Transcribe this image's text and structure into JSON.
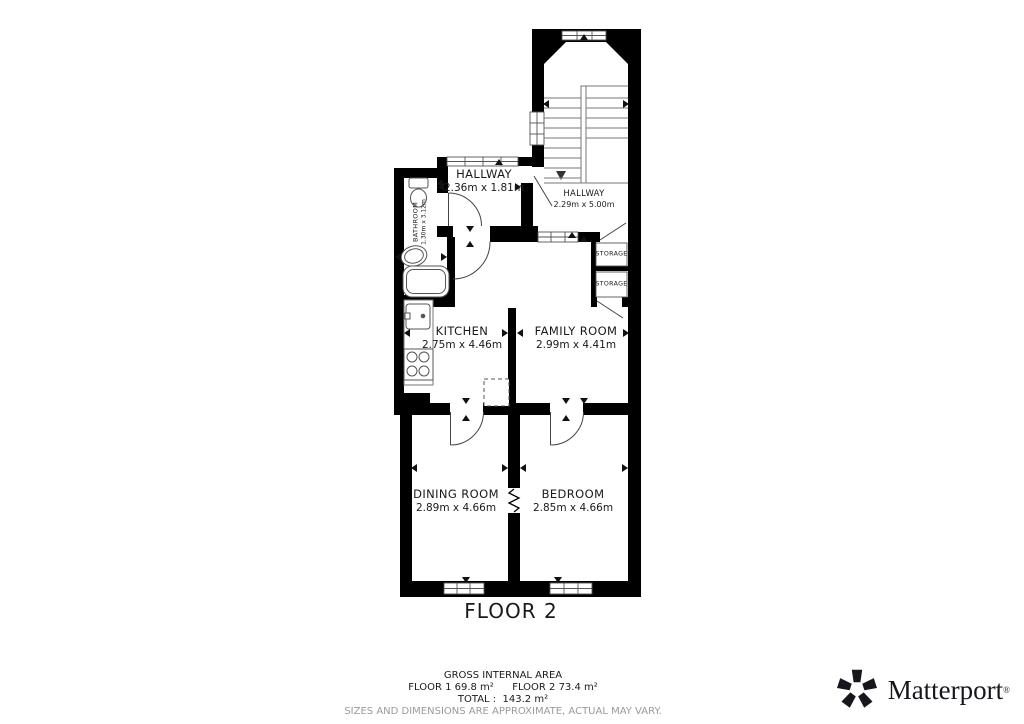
{
  "floor_plan": {
    "floor_label": "FLOOR 2",
    "rooms": {
      "hallway_top": {
        "name": "HALLWAY",
        "dims": "2.36m x 1.81m"
      },
      "hallway_right": {
        "name": "HALLWAY",
        "dims": "2.29m x 5.00m"
      },
      "bathroom": {
        "name": "BATHROOM",
        "dims": "1.30m x 3.12m"
      },
      "kitchen": {
        "name": "KITCHEN",
        "dims": "2.75m x 4.46m"
      },
      "family_room": {
        "name": "FAMILY ROOM",
        "dims": "2.99m x 4.41m"
      },
      "storage_1": {
        "name": "STORAGE"
      },
      "storage_2": {
        "name": "STORAGE"
      },
      "dining_room": {
        "name": "DINING ROOM",
        "dims": "2.89m x 4.66m"
      },
      "bedroom": {
        "name": "BEDROOM",
        "dims": "2.85m x 4.66m"
      }
    }
  },
  "footer": {
    "gross_internal_area": "GROSS INTERNAL AREA",
    "floor_1": "FLOOR 1 69.8 m²",
    "floor_2": "FLOOR 2 73.4 m²",
    "total": "TOTAL :  143.2 m²",
    "disclaimer": "SIZES AND DIMENSIONS ARE APPROXIMATE, ACTUAL MAY VARY."
  },
  "brand": {
    "name": "Matterport",
    "registered": "®"
  },
  "colors": {
    "wall": "#000000",
    "line": "#555555",
    "muted": "#9a9a9a"
  }
}
